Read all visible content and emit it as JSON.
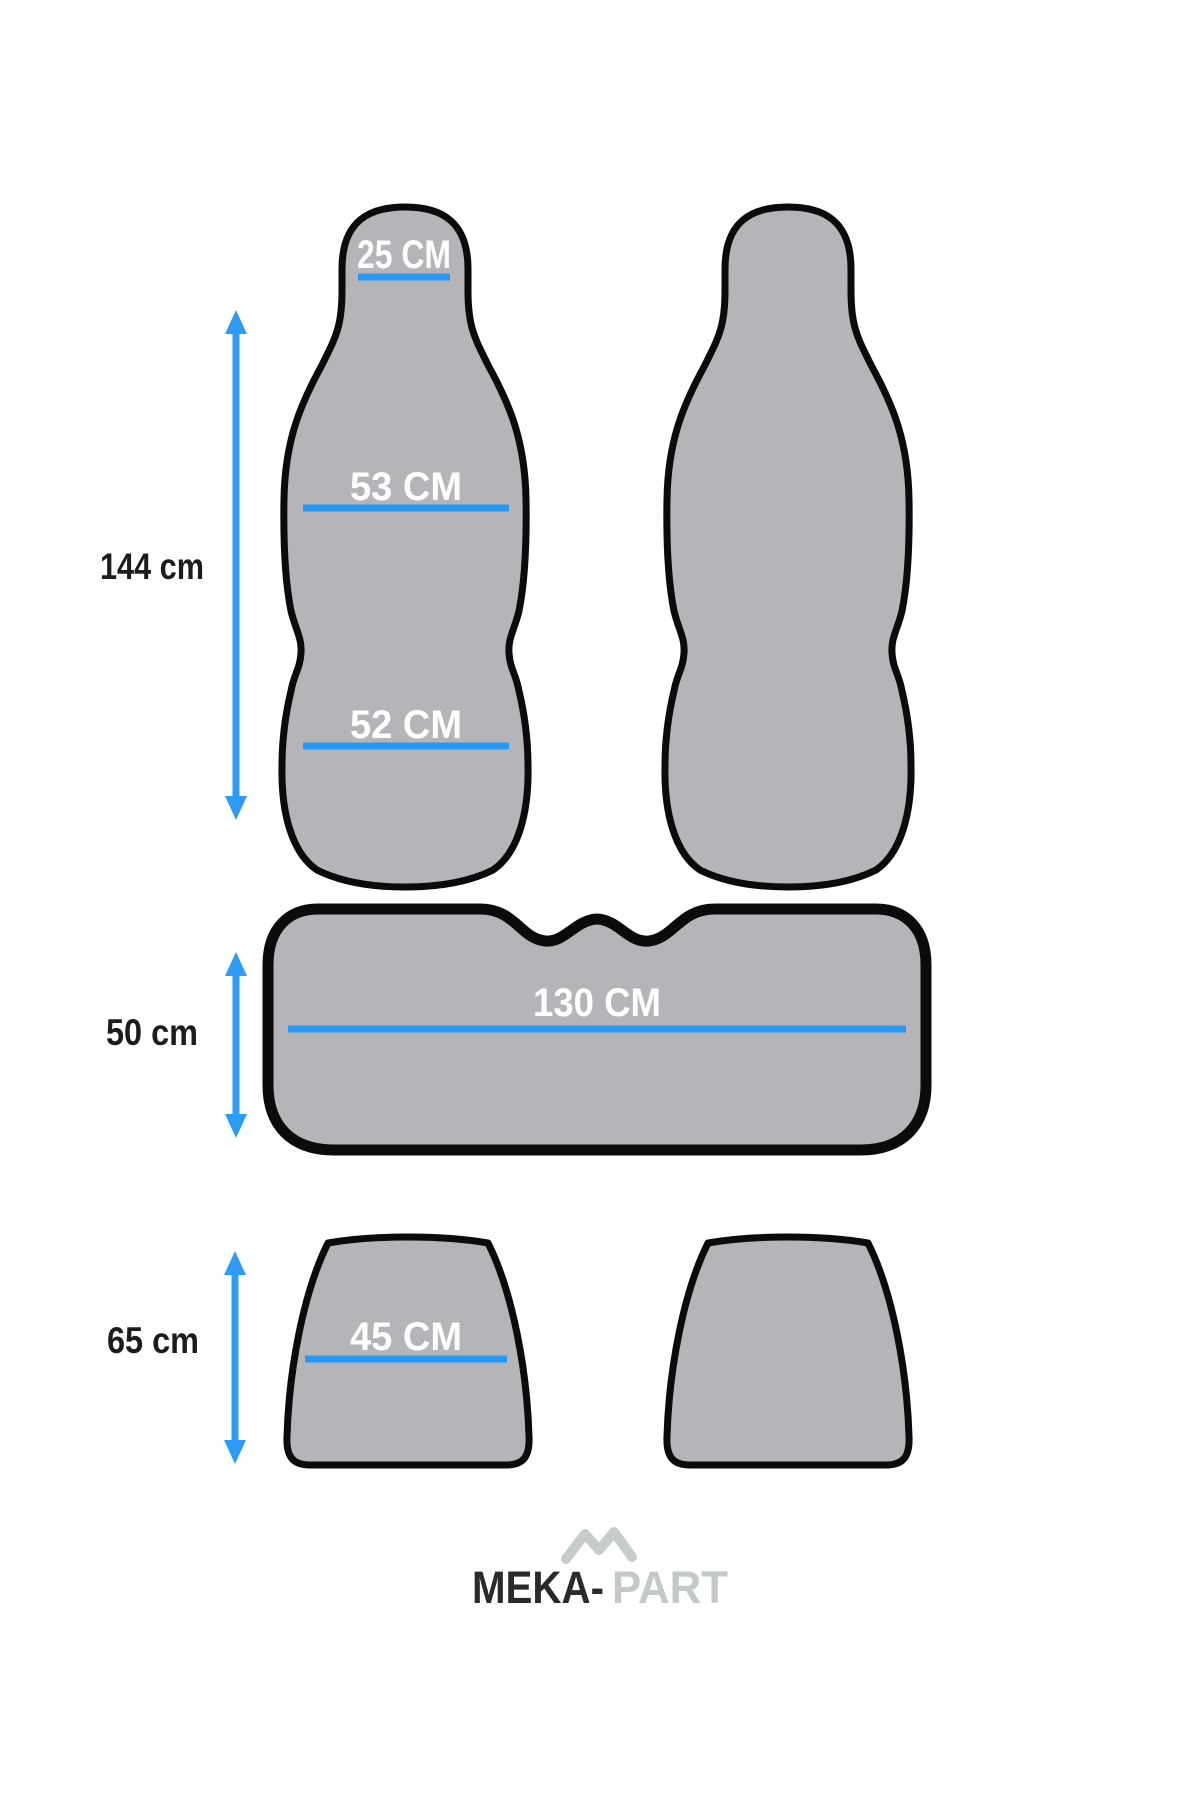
{
  "measurements": {
    "front_seat_height": "144 cm",
    "headrest_width": "25 CM",
    "backrest_upper_width": "53 CM",
    "backrest_lower_width": "52 CM",
    "bench_width": "130 CM",
    "bench_height": "50 cm",
    "cushion_width": "45 CM",
    "cushion_height": "65 cm"
  },
  "logo": {
    "icon": "mountain-m-icon",
    "text_dark": "MEKA-",
    "text_light": "PART"
  },
  "colors": {
    "shape_fill": "#b5b5b9",
    "outline": "#0b0b0b",
    "accent_blue": "#2598f5",
    "label_text": "#1c1c1e",
    "measure_text": "#ffffff",
    "logo_dark": "#2a2a2c",
    "logo_light": "#c3c9c9"
  }
}
